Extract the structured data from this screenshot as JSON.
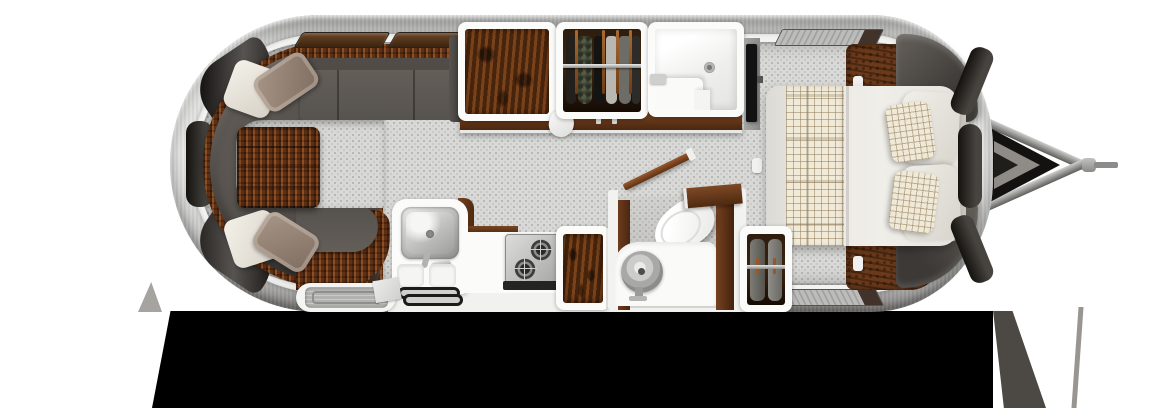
{
  "scene": {
    "name": "travel-trailer-floor-plan",
    "view": "top-down-3d-render",
    "canvas": {
      "width": 1170,
      "height": 408
    }
  },
  "palette": {
    "background": "#ffffff",
    "drop_shadow": "#000000",
    "shell_silver": "#d8d8d6",
    "rim_white": "#f3f3f1",
    "floor_gray": "#d8d8d6",
    "sofa_upholstery": "#57524e",
    "wicker_brown": "#713e1d",
    "cushion_white": "#f1ede5",
    "cushion_taupe": "#9b8a7c",
    "wood_burl": "#5e3212",
    "wardrobe_interior": "#2e1c0d",
    "fixture_white": "#fafaf8",
    "stainless_steel": "#b5b5b3",
    "bedding_white": "#ece9e3",
    "plaid_fabric": "#f0e9d7",
    "plaid_line": "#8c7855",
    "tv_black": "#121212",
    "hitch_gray": "#8c8c8a"
  },
  "areas": {
    "lounge": {
      "name": "rear-lounge",
      "furniture": [
        "u-shaped-sofa",
        "wicker-ottoman",
        "white-throw-pillows",
        "taupe-throw-pillows",
        "overhead-lockers",
        "curved-end-windows"
      ]
    },
    "galley": {
      "name": "galley-kitchen",
      "furniture": [
        "refrigerator-cabinet",
        "hanging-wardrobe",
        "stainless-sink",
        "faucet",
        "two-burner-stove",
        "cutting-boards",
        "pantry-cabinet",
        "entry-step",
        "floor-mats",
        "towel"
      ]
    },
    "bath": {
      "name": "bathroom",
      "furniture": [
        "shower-stall",
        "shower-drain",
        "toilet",
        "round-vanity-sink",
        "open-wood-door",
        "wood-partition-walls"
      ]
    },
    "bedroom": {
      "name": "front-bedroom",
      "furniture": [
        "double-bed",
        "plaid-runner",
        "white-pillows",
        "plaid-pillows",
        "headboard",
        "nightstands",
        "corner-cabinets",
        "hanging-wardrobe",
        "wall-tv",
        "overhead-bins"
      ]
    },
    "hitch": {
      "name": "tow-hitch",
      "parts": [
        "a-frame-arms",
        "jack",
        "coupler"
      ]
    }
  }
}
